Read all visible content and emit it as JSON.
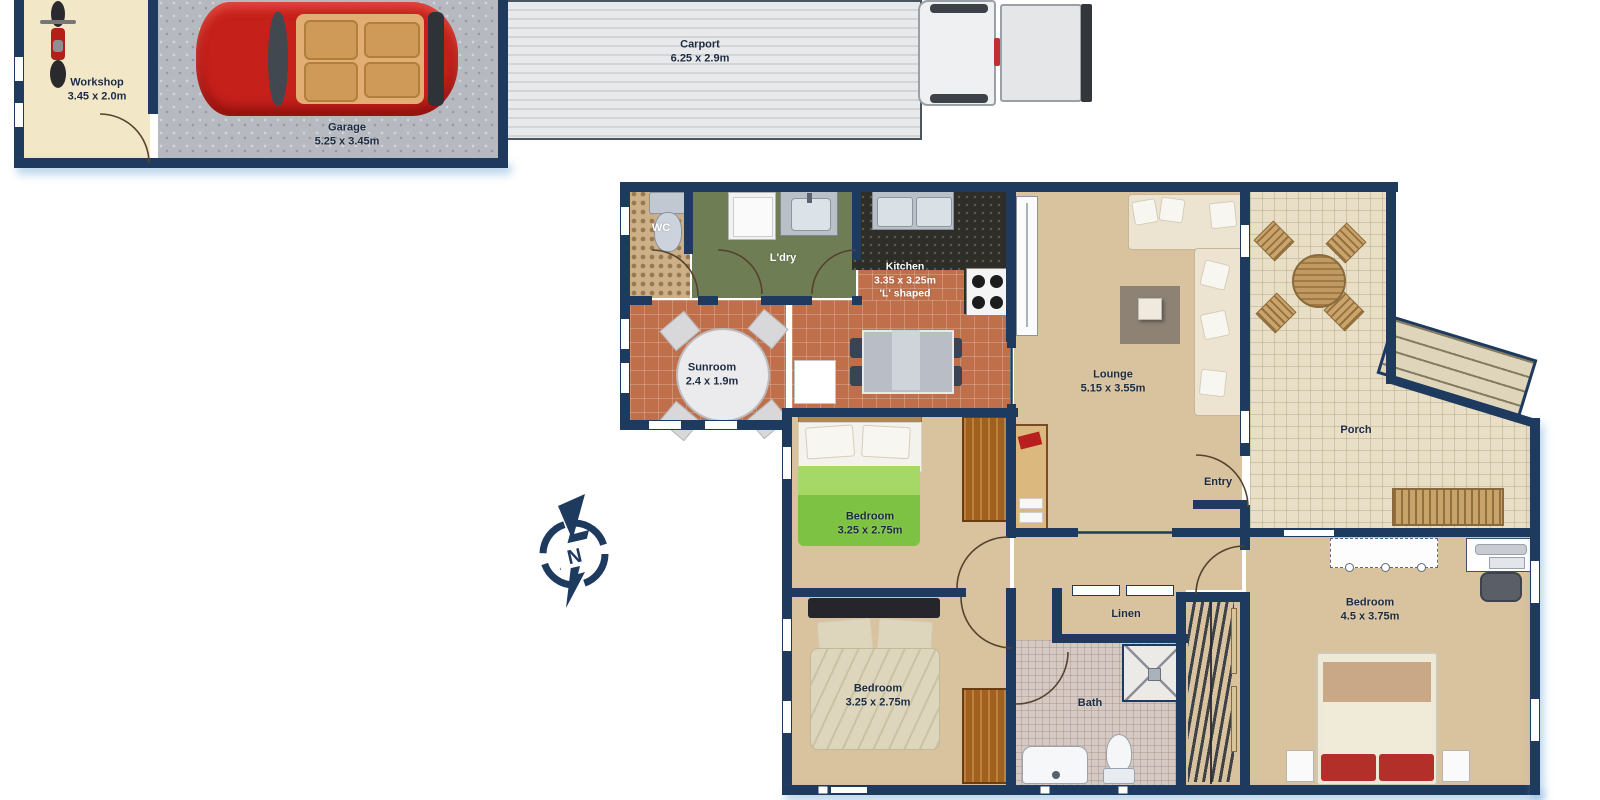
{
  "plan": {
    "rooms": {
      "workshop": {
        "name": "Workshop",
        "dims": "3.45 x 2.0m"
      },
      "garage": {
        "name": "Garage",
        "dims": "5.25 x 3.45m"
      },
      "carport": {
        "name": "Carport",
        "dims": "6.25 x 2.9m"
      },
      "wc": {
        "name": "WC"
      },
      "laundry": {
        "name": "L'dry"
      },
      "kitchen": {
        "name": "Kitchen",
        "dims": "3.35 x 3.25m",
        "note": "'L' shaped"
      },
      "sunroom": {
        "name": "Sunroom",
        "dims": "2.4 x 1.9m"
      },
      "lounge": {
        "name": "Lounge",
        "dims": "5.15 x 3.55m"
      },
      "porch": {
        "name": "Porch"
      },
      "entry": {
        "name": "Entry"
      },
      "bedroom_1": {
        "name": "Bedroom",
        "dims": "3.25 x 2.75m"
      },
      "bedroom_2": {
        "name": "Bedroom",
        "dims": "3.25 x 2.75m"
      },
      "bedroom_main": {
        "name": "Bedroom",
        "dims": "4.5 x 3.75m"
      },
      "linen": {
        "name": "Linen"
      },
      "bath": {
        "name": "Bath"
      }
    },
    "compass": {
      "label": "N"
    },
    "colors": {
      "wall": "#1e3a5f",
      "floor_beige": "#d9c29e",
      "floor_terracotta": "#bf6f4a",
      "floor_olive": "#6f7d55",
      "floor_cream": "#f2e7c6",
      "floor_concrete": "#b6bac0",
      "floor_porch": "#e9dfc6",
      "bed_green": "#7dc242",
      "car_red": "#c6201b",
      "accent_red": "#b3302a"
    }
  }
}
